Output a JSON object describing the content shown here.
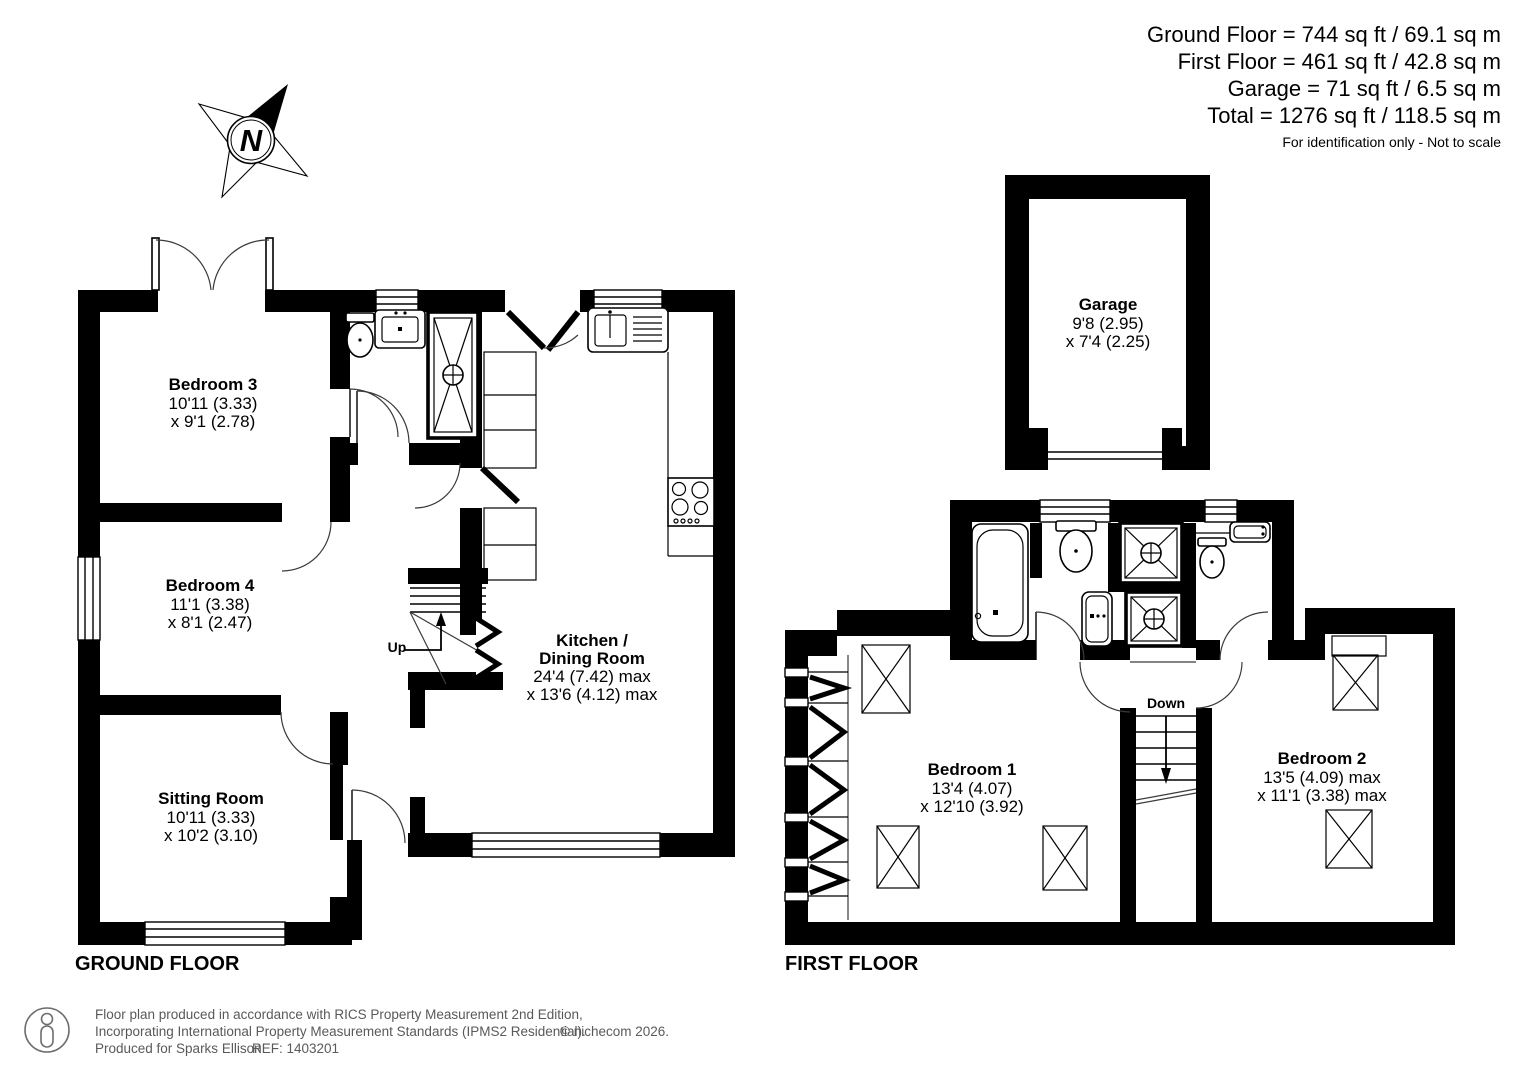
{
  "header": {
    "area_lines": [
      "Ground Floor = 744 sq ft / 69.1 sq m",
      "First Floor = 461 sq ft / 42.8 sq m",
      "Garage = 71 sq ft / 6.5 sq m",
      "Total = 1276 sq ft / 118.5 sq m"
    ],
    "disclaimer": "For identification only - Not to scale"
  },
  "compass": {
    "north_label": "N"
  },
  "ground_floor": {
    "title": "GROUND FLOOR",
    "stairs_label": "Up",
    "rooms": {
      "bedroom3": {
        "name": "Bedroom 3",
        "dims": [
          "10'11 (3.33)",
          "x 9'1 (2.78)"
        ]
      },
      "bedroom4": {
        "name": "Bedroom 4",
        "dims": [
          "11'1 (3.38)",
          "x 8'1 (2.47)"
        ]
      },
      "sitting_room": {
        "name": "Sitting Room",
        "dims": [
          "10'11 (3.33)",
          "x 10'2 (3.10)"
        ]
      },
      "kitchen": {
        "name_line1": "Kitchen /",
        "name_line2": "Dining Room",
        "dims": [
          "24'4 (7.42) max",
          "x 13'6 (4.12) max"
        ]
      }
    }
  },
  "first_floor": {
    "title": "FIRST FLOOR",
    "stairs_label": "Down",
    "rooms": {
      "garage": {
        "name": "Garage",
        "dims": [
          "9'8 (2.95)",
          "x 7'4 (2.25)"
        ]
      },
      "bedroom1": {
        "name": "Bedroom 1",
        "dims": [
          "13'4 (4.07)",
          "x 12'10 (3.92)"
        ]
      },
      "bedroom2": {
        "name": "Bedroom 2",
        "dims": [
          "13'5 (4.09) max",
          "x 11'1 (3.38) max"
        ]
      }
    }
  },
  "footer": {
    "line1": "Floor plan produced in accordance with RICS Property Measurement 2nd Edition,",
    "line2": "Incorporating International Property Measurement Standards (IPMS2 Residential).",
    "line3": "Produced for Sparks Ellison.",
    "ref": "REF: 1403201",
    "copyright": "© nichecom 2026."
  }
}
